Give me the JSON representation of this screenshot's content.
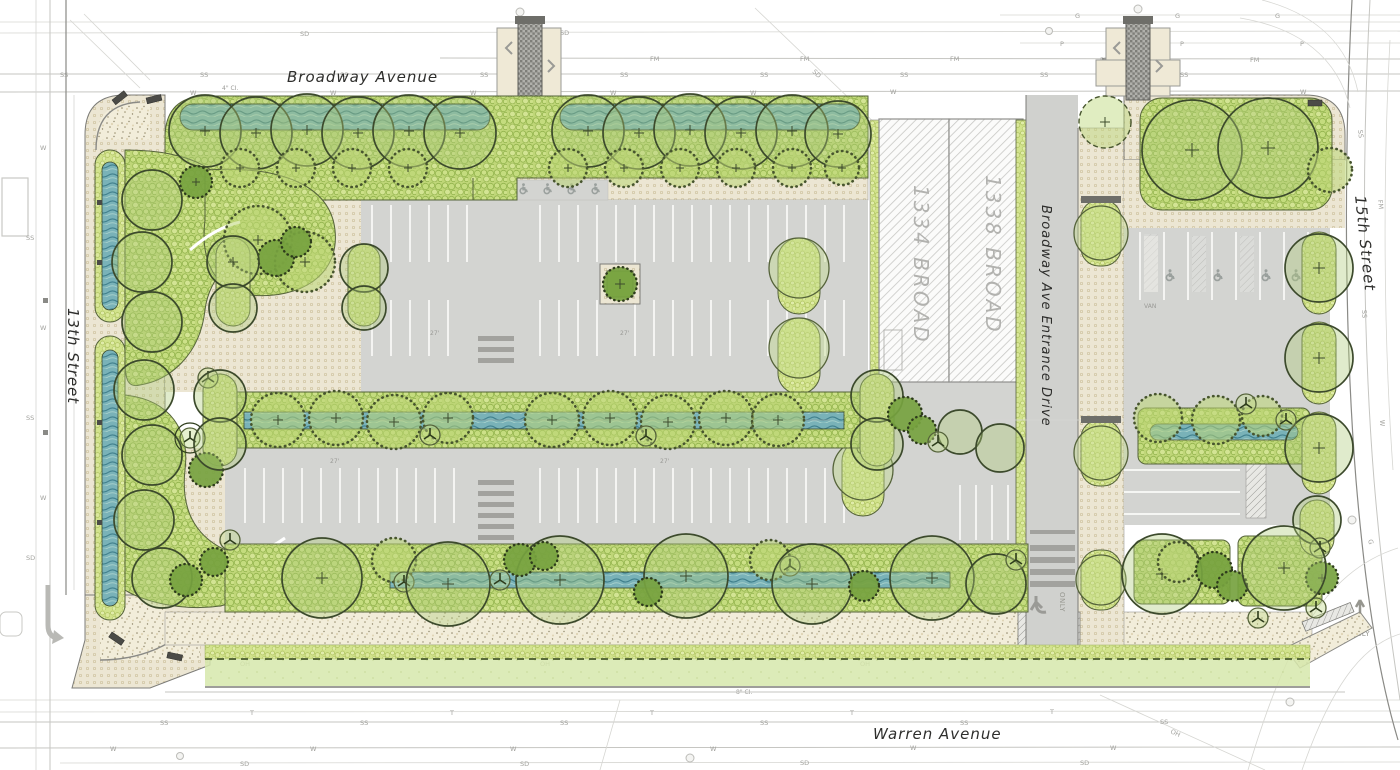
{
  "streets": {
    "broadway": "Broadway Avenue",
    "warren": "Warren Avenue",
    "thirteenth": "13th Street",
    "fifteenth": "15th Street",
    "entrance": "Broadway Ave Entrance Drive"
  },
  "buildings": {
    "b1334": "1334 BROAD",
    "b1338": "1338 BROAD"
  },
  "markings": {
    "van": "VAN",
    "only": "ONLY"
  },
  "utilities": {
    "ss": "SS",
    "w": "W",
    "fm": "FM",
    "g": "G",
    "sd": "SD",
    "oh": "OH",
    "t": "T",
    "p": "P"
  },
  "pipes": {
    "ci8": "8\" CI.",
    "ci4": "4\" CI."
  },
  "dims": {
    "aisle": "27'"
  },
  "colors": {
    "asphalt": "#d3d4d1",
    "paver": "#ece6d3",
    "gravel": "#f2edda",
    "planting": "#bfd678",
    "planting_fine": "#d2e38c",
    "lawn": "#d6e7ab",
    "swale_blue": "#79b2b8",
    "canopy_outline": "#3c4a2c",
    "building_hatch": "#c8c8c5",
    "crosswalk_brick": "#86867f",
    "text_dark": "#2e2e2c",
    "text_gray": "#a2a29e"
  }
}
